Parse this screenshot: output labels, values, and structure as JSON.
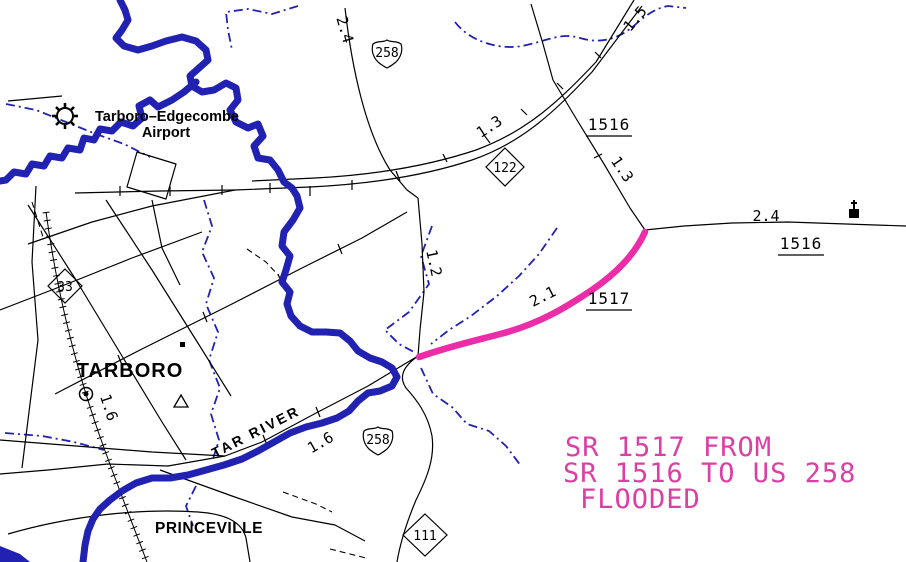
{
  "annotation": {
    "line1": "SR 1517 FROM",
    "line2": "SR 1516 TO US 258",
    "line3": "FLOODED"
  },
  "places": {
    "airport_line1": "Tarboro–Edgecombe",
    "airport_line2": "Airport",
    "city": "TARBORO",
    "town": "PRINCEVILLE",
    "river": "TAR RIVER"
  },
  "shields": {
    "us258_north": "258",
    "us258_south": "258",
    "nc33": "33",
    "nc122": "122",
    "nc111": "111"
  },
  "routes": {
    "sr1516_upper": "1516",
    "sr1516_east": "1516",
    "sr1517": "1517"
  },
  "distances": {
    "d24_north": "2.4",
    "d13_hwy": "1.3",
    "d15_hwy": "1.5",
    "d13_1516": "1.3",
    "d24_east": "2.4",
    "d12_south": "1.2",
    "d21_1517": "2.1",
    "d16_tarboro": "1.6",
    "d16_258": "1.6"
  },
  "colors": {
    "water": "#2121B2",
    "highlight": "#ED2CA8",
    "annotation_text": "#DB3FA3",
    "line": "#000000",
    "bg": "#FFFFFF"
  }
}
